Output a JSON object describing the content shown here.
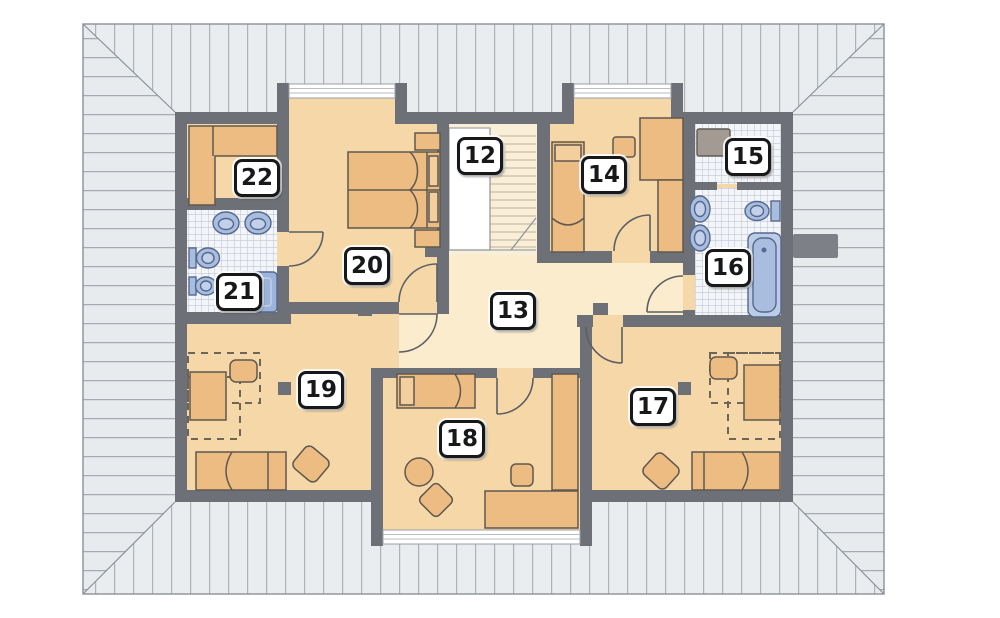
{
  "plan": {
    "kind": "floor-plan",
    "rooms": [
      {
        "number": "12",
        "depicts": "staircase"
      },
      {
        "number": "13",
        "depicts": "hall"
      },
      {
        "number": "14",
        "depicts": "bedroom"
      },
      {
        "number": "15",
        "depicts": "utility-room"
      },
      {
        "number": "16",
        "depicts": "bathroom"
      },
      {
        "number": "17",
        "depicts": "bedroom"
      },
      {
        "number": "18",
        "depicts": "bedroom"
      },
      {
        "number": "19",
        "depicts": "bedroom"
      },
      {
        "number": "20",
        "depicts": "bedroom"
      },
      {
        "number": "21",
        "depicts": "bathroom"
      },
      {
        "number": "22",
        "depicts": "wardrobe"
      }
    ],
    "colors": {
      "roof_fill": "#eaedef",
      "roof_line": "#aeb3ba",
      "wall": "#6d7177",
      "room_floor": "#f6d8a8",
      "hall_floor": "#fbeccd",
      "furniture": "#ecbc83",
      "tile_floor": "#f3f5f9",
      "fixture_blue": "#a9bedf",
      "label_border": "#17181a"
    }
  }
}
